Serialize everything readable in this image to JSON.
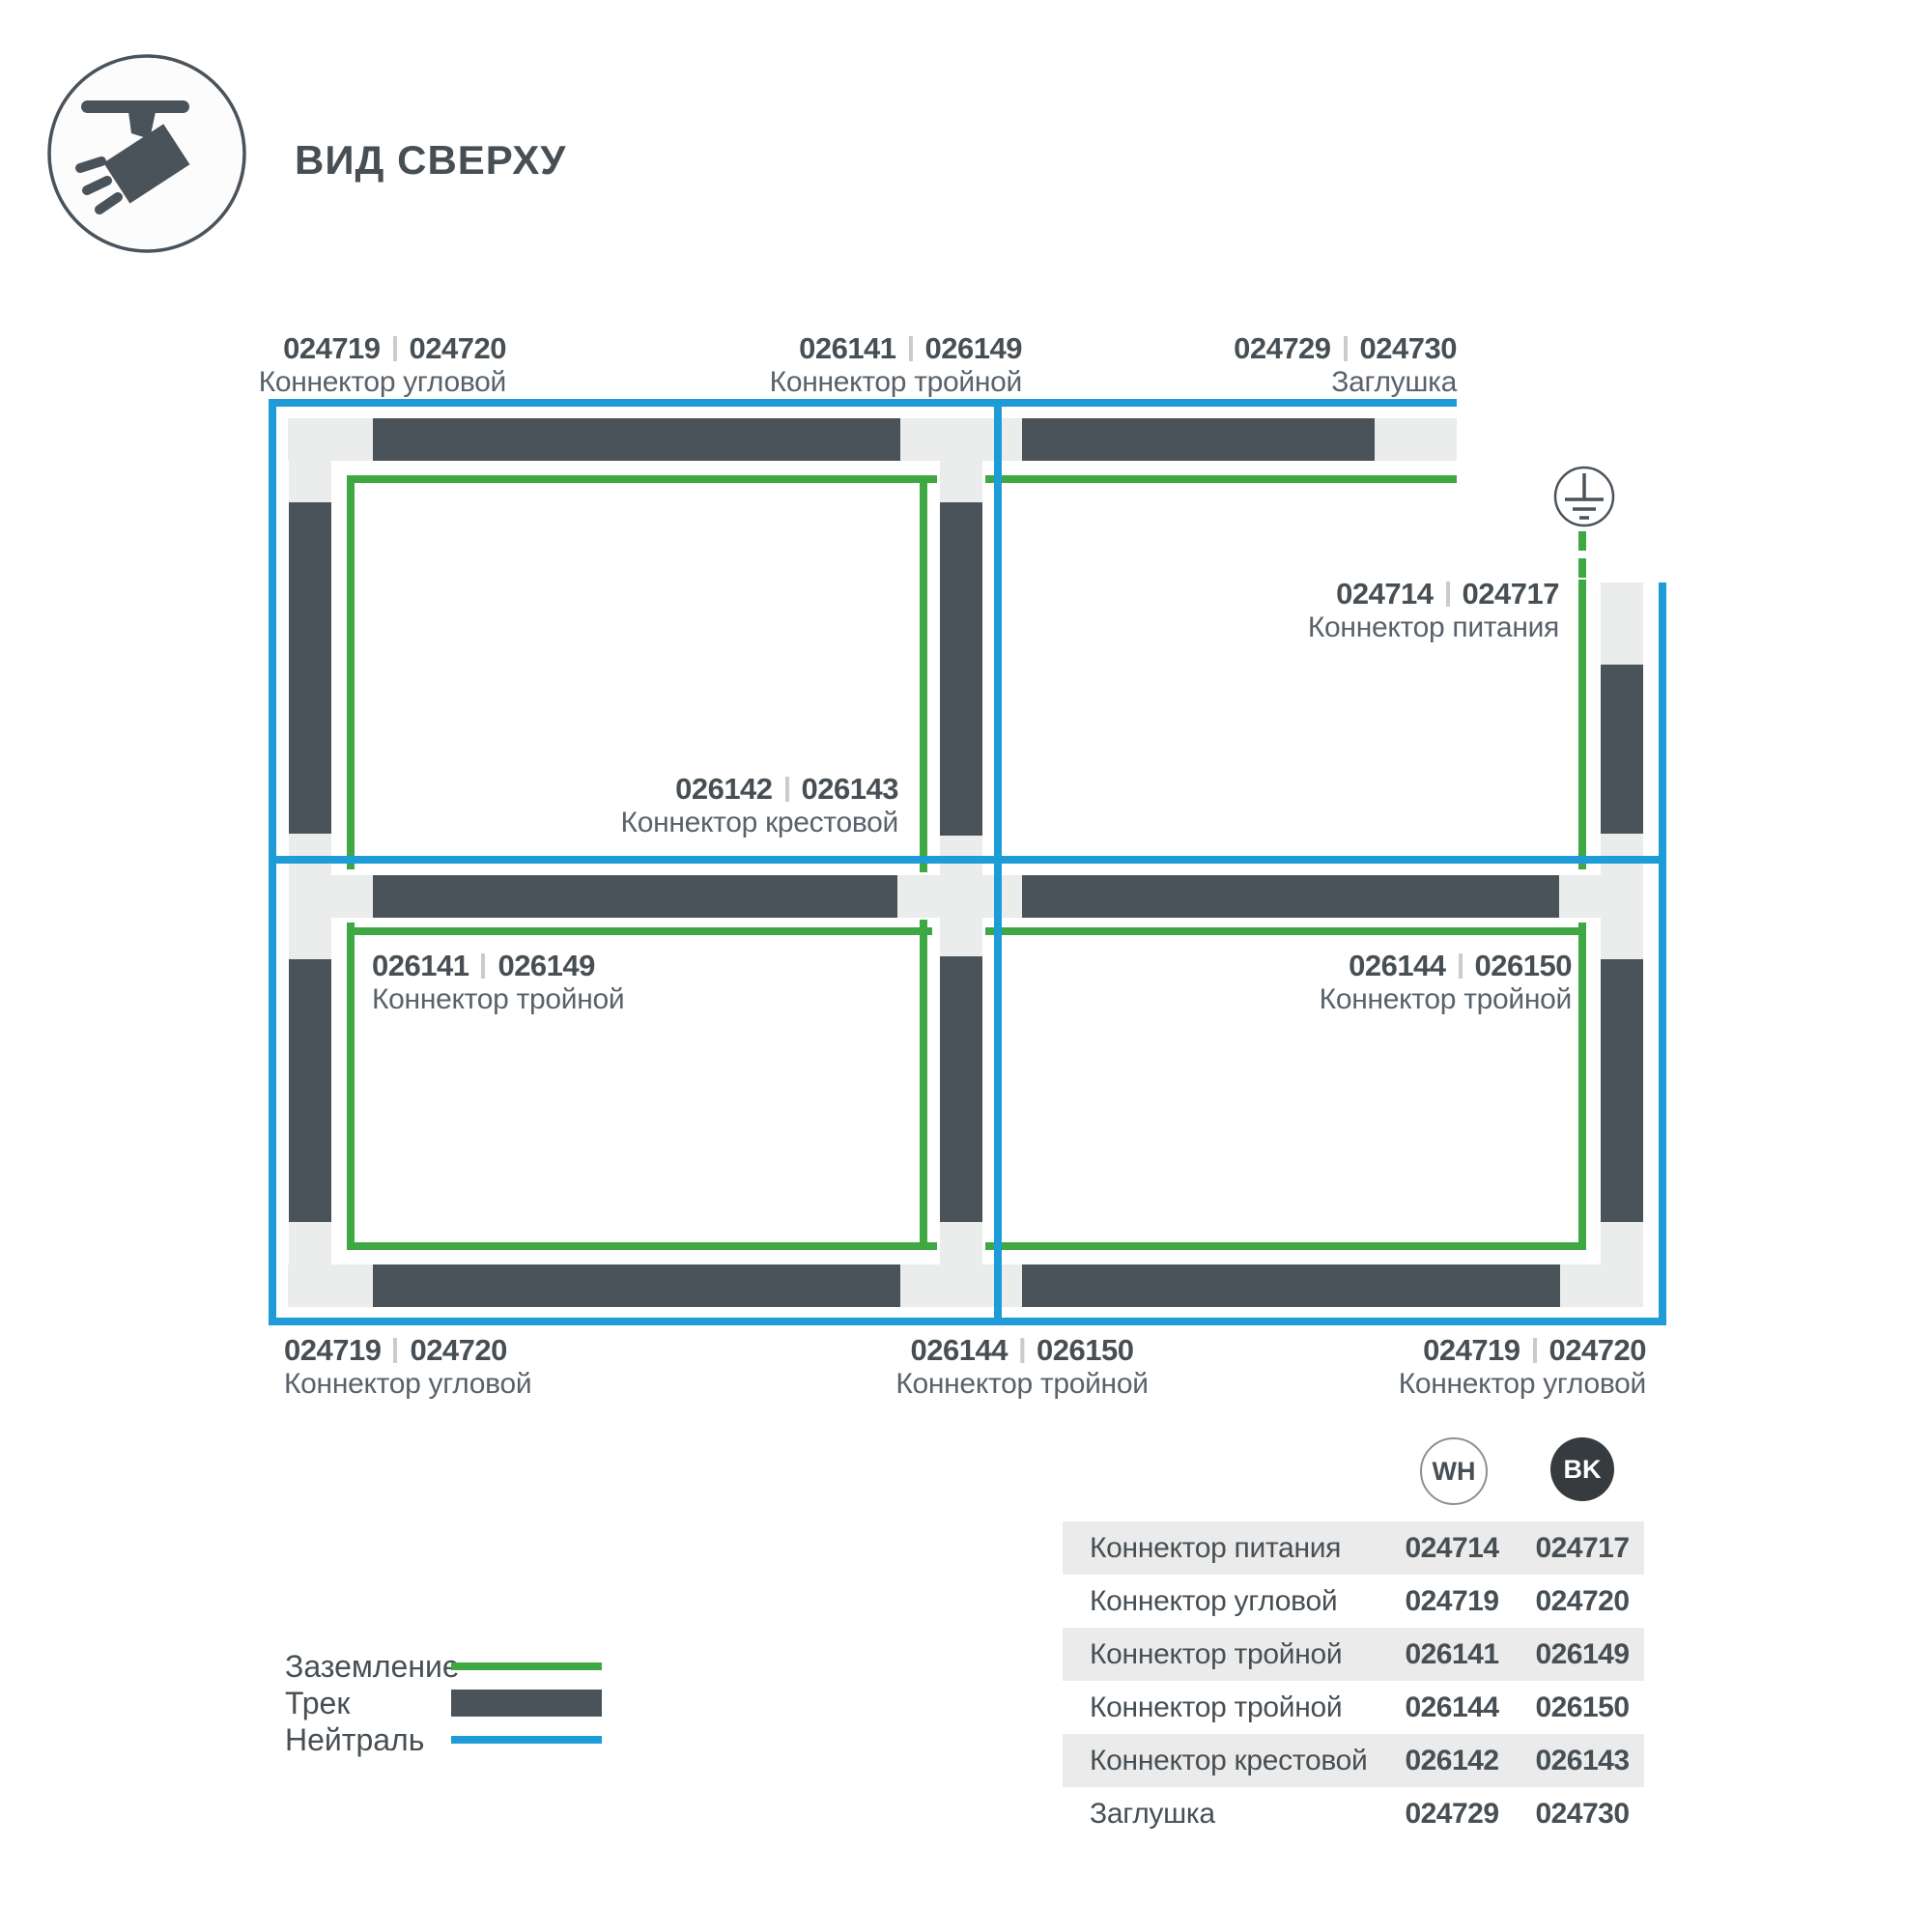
{
  "colors": {
    "track": "#4A525A",
    "plate": "#EBECEC",
    "ground": "#3EA843",
    "neutral": "#1E9CD7",
    "text_dark": "#474F54",
    "text_medium": "#59626A",
    "row_alt": "#EBEBEB",
    "bk_badge": "#363B3F"
  },
  "header": {
    "title": "ВИД СВЕРХУ",
    "icon": "track-light-top-view-icon"
  },
  "diagram": {
    "ground_symbol_icon": "earth-ground-icon",
    "labels": [
      {
        "id": "corner-top-left",
        "codes": [
          "024719",
          "024720"
        ],
        "name": "Коннектор угловой"
      },
      {
        "id": "tee-top",
        "codes": [
          "026141",
          "026149"
        ],
        "name": "Коннектор тройной"
      },
      {
        "id": "endcap-top-right",
        "codes": [
          "024729",
          "024730"
        ],
        "name": "Заглушка"
      },
      {
        "id": "power-right",
        "codes": [
          "024714",
          "024717"
        ],
        "name": "Коннектор питания"
      },
      {
        "id": "cross-center",
        "codes": [
          "026142",
          "026143"
        ],
        "name": "Коннектор крестовой"
      },
      {
        "id": "tee-mid-left",
        "codes": [
          "026141",
          "026149"
        ],
        "name": "Коннектор тройной"
      },
      {
        "id": "tee-mid-right",
        "codes": [
          "026144",
          "026150"
        ],
        "name": "Коннектор тройной"
      },
      {
        "id": "corner-bottom-left",
        "codes": [
          "024719",
          "024720"
        ],
        "name": "Коннектор угловой"
      },
      {
        "id": "tee-bottom",
        "codes": [
          "026144",
          "026150"
        ],
        "name": "Коннектор тройной"
      },
      {
        "id": "corner-bottom-right",
        "codes": [
          "024719",
          "024720"
        ],
        "name": "Коннектор угловой"
      }
    ]
  },
  "legend": {
    "items": [
      {
        "label": "Заземление",
        "swatch": "ground-line"
      },
      {
        "label": "Трек",
        "swatch": "track-bar"
      },
      {
        "label": "Нейтраль",
        "swatch": "neutral-line"
      }
    ]
  },
  "table": {
    "col_badges": [
      {
        "label": "WH",
        "variant": "outline"
      },
      {
        "label": "BK",
        "variant": "filled"
      }
    ],
    "rows": [
      {
        "name": "Коннектор питания",
        "wh": "024714",
        "bk": "024717"
      },
      {
        "name": "Коннектор угловой",
        "wh": "024719",
        "bk": "024720"
      },
      {
        "name": "Коннектор тройной",
        "wh": "026141",
        "bk": "026149"
      },
      {
        "name": "Коннектор тройной",
        "wh": "026144",
        "bk": "026150"
      },
      {
        "name": "Коннектор крестовой",
        "wh": "026142",
        "bk": "026143"
      },
      {
        "name": "Заглушка",
        "wh": "024729",
        "bk": "024730"
      }
    ]
  }
}
